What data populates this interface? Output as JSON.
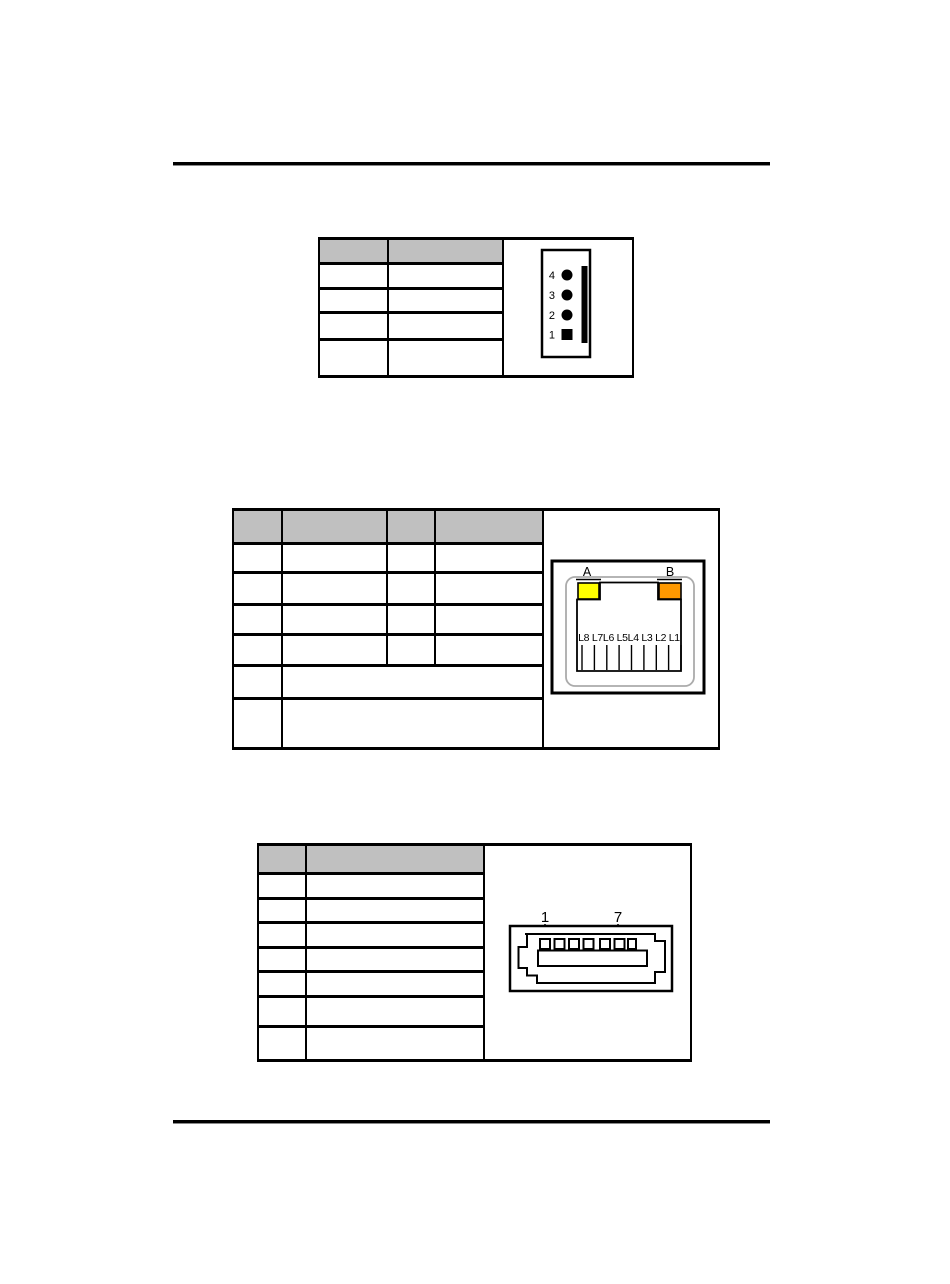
{
  "page": {
    "background": "#ffffff",
    "width": 950,
    "height": 1284,
    "content": "blank scanned manual page with header and footer rules"
  },
  "tables": {
    "four_pin_header": {
      "position": "top",
      "header_fill": "#c0c0c0",
      "header_cells": [
        "",
        ""
      ],
      "data_rows": [
        [
          "",
          ""
        ],
        [
          "",
          ""
        ],
        [
          "",
          ""
        ],
        [
          "",
          ""
        ]
      ],
      "diagram": {
        "type": "4-pin-header-connector",
        "pin_labels": [
          "4",
          "3",
          "2",
          "1"
        ],
        "pin_1_shape": "square",
        "other_pin_shape": "circle"
      }
    },
    "lan_led_table": {
      "position": "middle",
      "header_fill": "#c0c0c0",
      "header_cells": [
        "",
        "",
        "",
        ""
      ],
      "data_rows_4col": [
        [
          "",
          "",
          "",
          ""
        ],
        [
          "",
          "",
          "",
          ""
        ],
        [
          "",
          "",
          "",
          ""
        ],
        [
          "",
          "",
          "",
          ""
        ]
      ],
      "data_rows_merged": [
        [
          "",
          ""
        ],
        [
          "",
          ""
        ]
      ],
      "diagram": {
        "type": "rj45-jack-with-leds",
        "led_a_label": "A",
        "led_b_label": "B",
        "led_a_color": "#ffff00",
        "led_b_color": "#ff9900",
        "lane_labels": "L8 L7L6 L5L4 L3 L2 L1",
        "pin_slot_count": 9
      }
    },
    "sata_table": {
      "position": "bottom",
      "header_fill": "#c0c0c0",
      "header_cells": [
        "",
        ""
      ],
      "data_rows": [
        [
          "",
          ""
        ],
        [
          "",
          ""
        ],
        [
          "",
          ""
        ],
        [
          "",
          ""
        ],
        [
          "",
          ""
        ],
        [
          "",
          ""
        ],
        [
          "",
          ""
        ]
      ],
      "diagram": {
        "type": "7-pin-sata-connector",
        "first_pin_label": "1",
        "last_pin_label": "7",
        "pin_count": 7
      }
    }
  }
}
